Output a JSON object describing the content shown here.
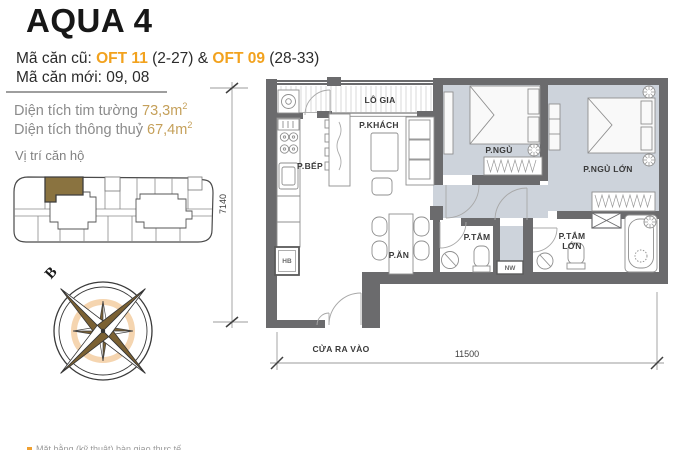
{
  "header": {
    "title": "AQUA 4",
    "unit_old": {
      "label": "Mã căn cũ: ",
      "code_1": "OFT 11",
      "suffix_1": " (2-27)",
      "joiner": " & ",
      "code_2": "OFT 09",
      "suffix_2": " (28-33)"
    },
    "unit_new": "Mã căn mới: 09, 08",
    "area_tim_tuong": {
      "label": "Diện tích tim tường ",
      "value": "73,3m",
      "sup": "2"
    },
    "area_thong_thuy": {
      "label": "Diện tích thông thuỷ ",
      "value": "67,4m",
      "sup": "2"
    }
  },
  "location": {
    "label": "Vị trí căn hộ"
  },
  "compass": {
    "north": "B"
  },
  "plan": {
    "rooms": {
      "logia": "LÔ GIA",
      "living": "P.KHÁCH",
      "kitchen": "P.BẾP",
      "dining": "P.ĂN",
      "bedroom": "P.NGỦ",
      "master_bedroom": "P.NGỦ LỚN",
      "bathroom": "P.TẮM",
      "master_bathroom_line1": "P.TẮM",
      "master_bathroom_line2": "LỚN",
      "entrance": "CỬA RA VÀO"
    },
    "fixtures": {
      "hb": "HB",
      "nw": "NW"
    },
    "dims": {
      "horizontal": "11500",
      "vertical": "7140"
    }
  },
  "footnote": {
    "text": "Mặt bằng (kỹ thuật) bàn giao thực tế"
  },
  "colors": {
    "accent": "#F2A21E",
    "area_value": "#C5A05A",
    "muted_text": "#8B8B8B",
    "wall": "#6B6B6D",
    "floor_gray": "#CDD3DB",
    "unit_highlight": "#8A7340"
  }
}
